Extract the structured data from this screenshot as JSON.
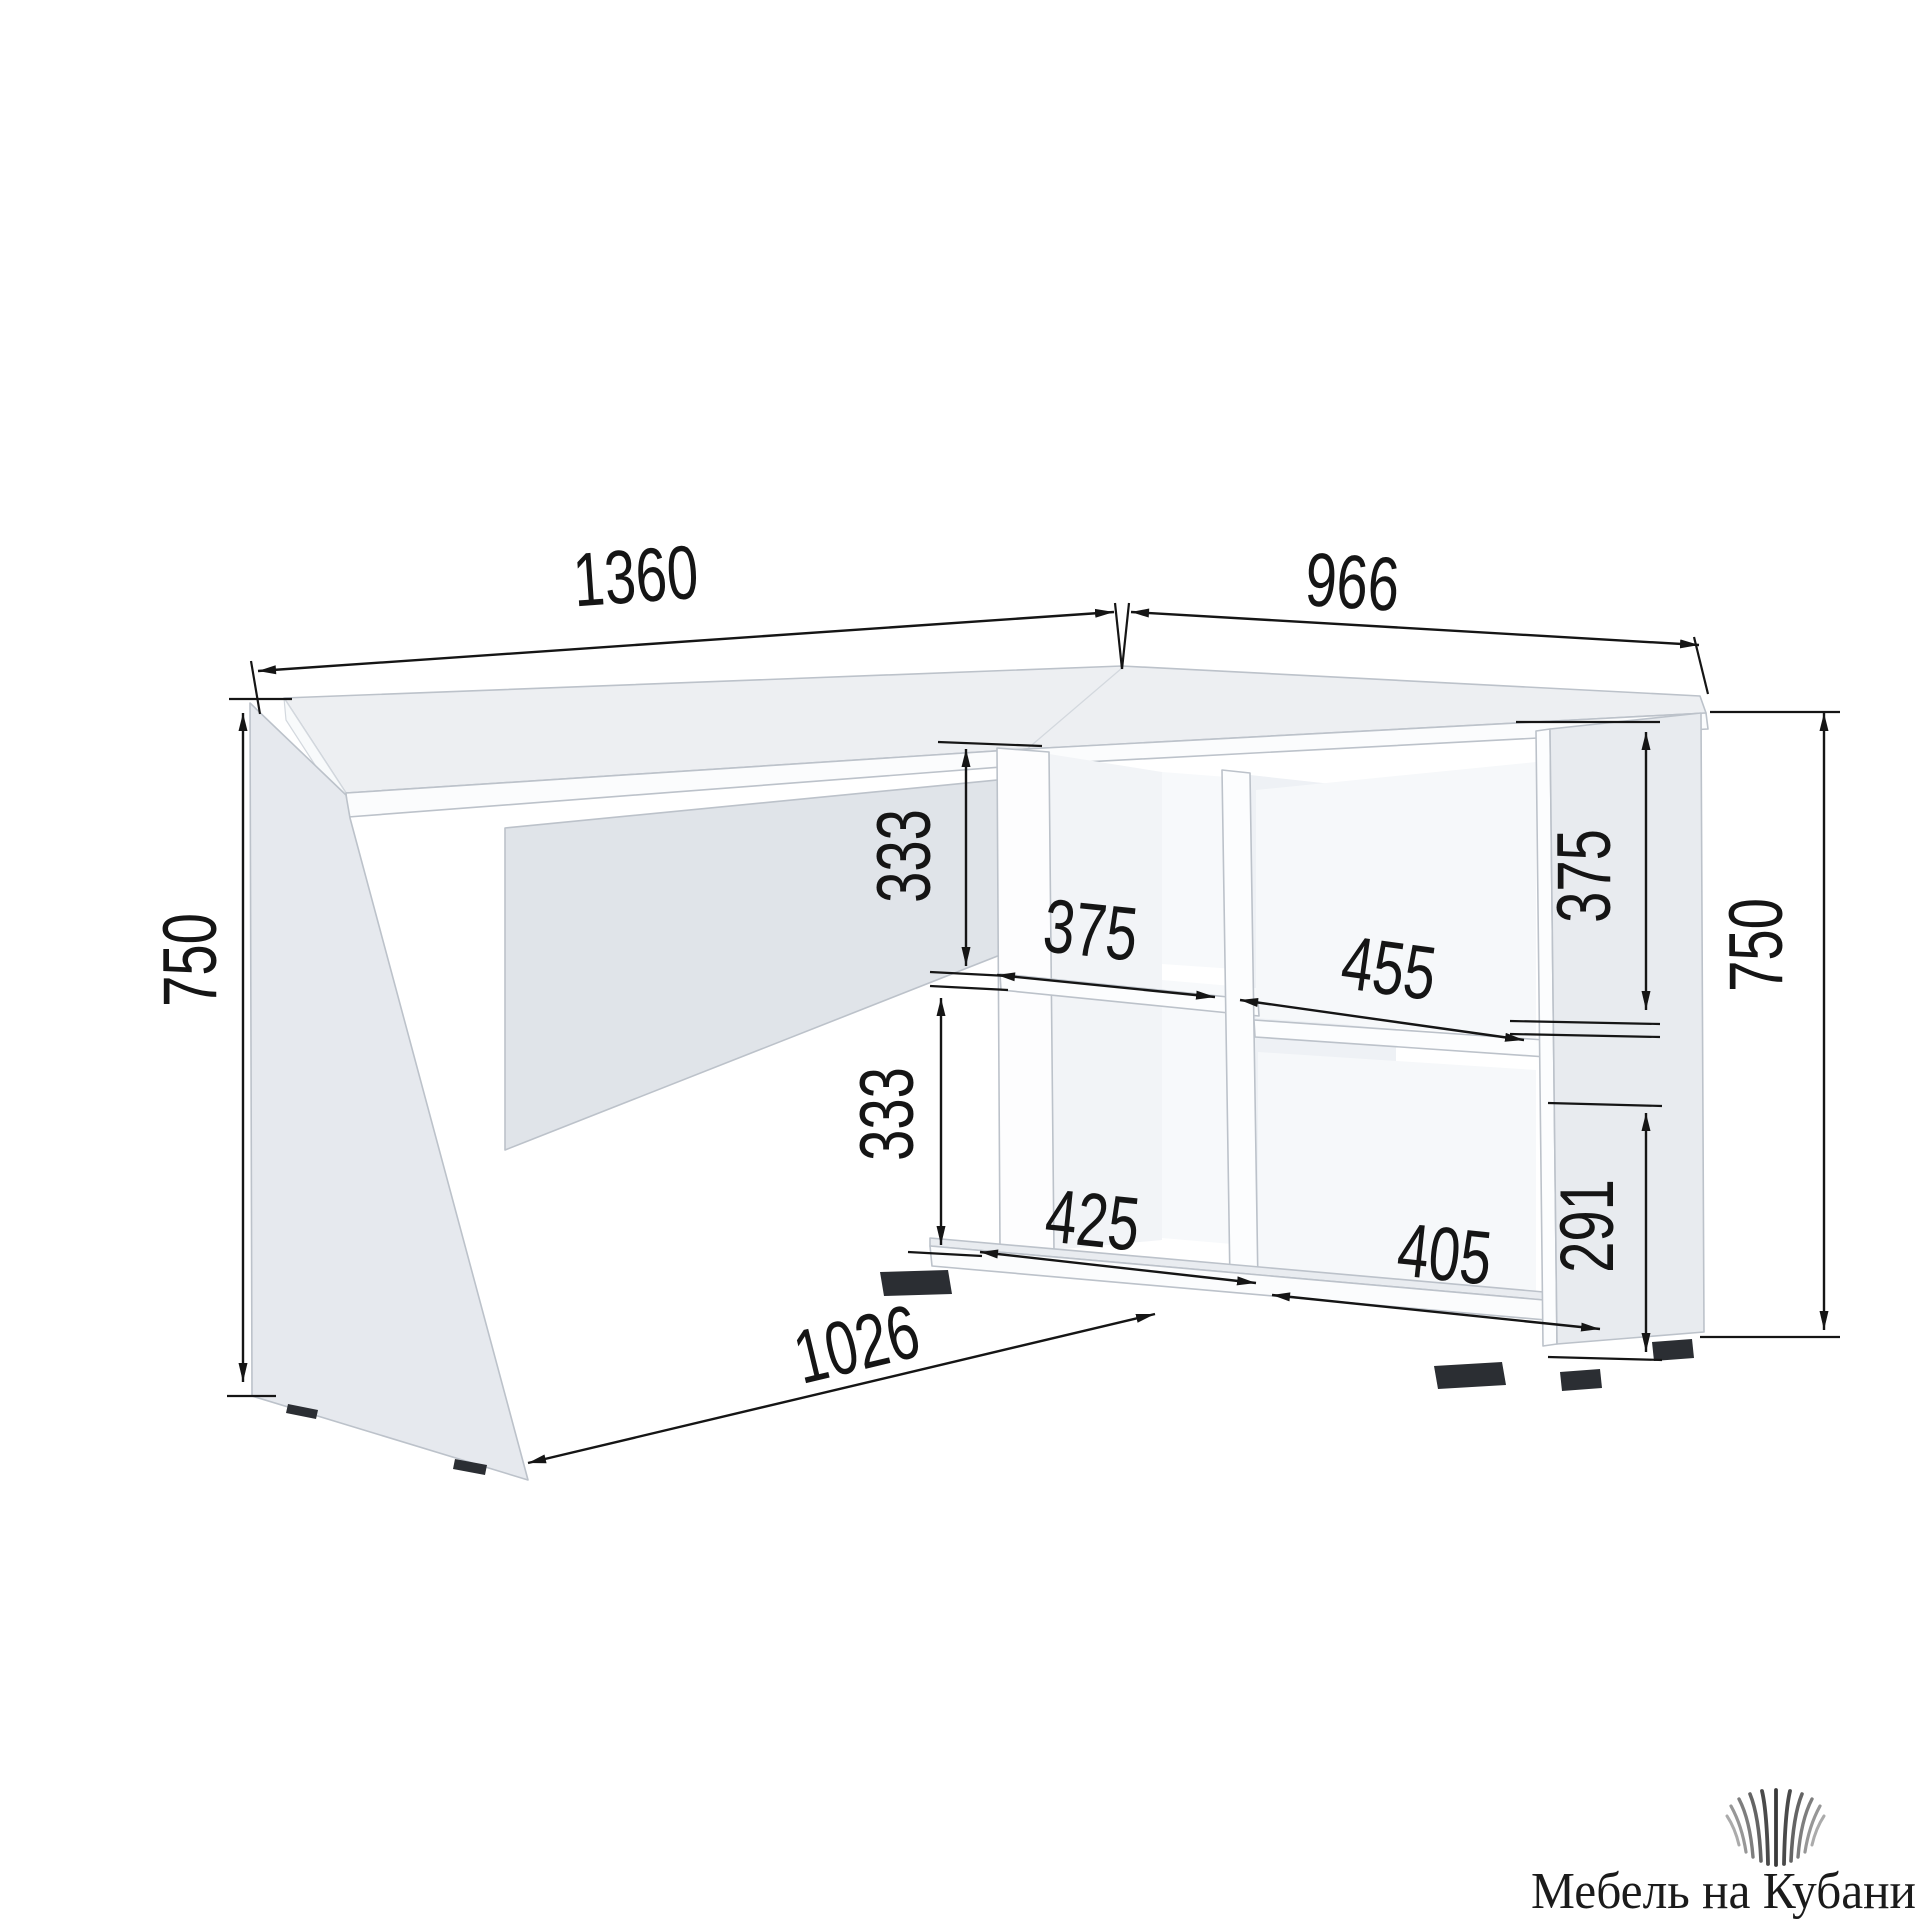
{
  "diagram": {
    "dims": {
      "desk_width": "1360",
      "wing_depth": "966",
      "left_height": "750",
      "upper_gap": "333",
      "left_shelf_top_width": "375",
      "wing_shelf_width": "455",
      "wing_upper_height": "375",
      "right_height": "750",
      "lower_gap": "333",
      "left_shelf_bottom_width": "425",
      "wing_lower_width": "405",
      "wing_lower_height": "291",
      "base_width": "1026"
    }
  },
  "watermark": {
    "brand_name": "Мебель на Кубани",
    "logo_icon": "fan-lines-logo-icon"
  },
  "colors": {
    "dimension_ink": "#151515",
    "panel_light": "#e8ebef",
    "panel_mid": "#e0e4e9",
    "outline": "#bcc2ca",
    "foot": "#2b2e33"
  }
}
